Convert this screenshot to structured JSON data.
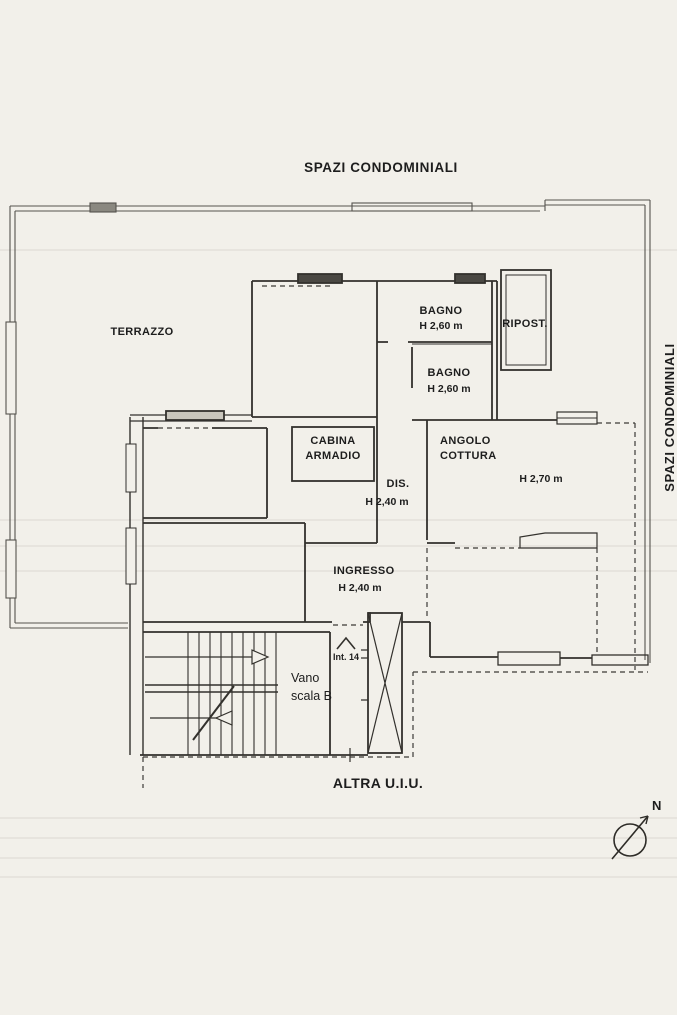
{
  "title_top": "SPAZI CONDOMINIALI",
  "side_label": "SPAZI CONDOMINIALI",
  "rooms": {
    "terrazzo": {
      "name": "TERRAZZO"
    },
    "bagno1": {
      "name": "BAGNO",
      "height": "H 2,60 m"
    },
    "ripostiglio": {
      "name": "RIPOST."
    },
    "bagno2": {
      "name": "BAGNO",
      "height": "H 2,60 m"
    },
    "cabina_armadio": {
      "line1": "CABINA",
      "line2": "ARMADIO"
    },
    "angolo_cottura": {
      "line1": "ANGOLO",
      "line2": "COTTURA"
    },
    "disimpegno": {
      "name": "DIS.",
      "height": "H 2,40 m"
    },
    "soggiorno": {
      "height": "H 2,70 m"
    },
    "ingresso": {
      "name": "INGRESSO",
      "height": "H 2,40 m"
    },
    "vano_scala": {
      "line1": "Vano",
      "line2": "scala B"
    }
  },
  "annotations": {
    "interno": "Int. 14",
    "altra_uiu": "ALTRA U.I.U.",
    "north": "N"
  },
  "colors": {
    "paper": "#f2f0ea",
    "ink": "#333333"
  }
}
